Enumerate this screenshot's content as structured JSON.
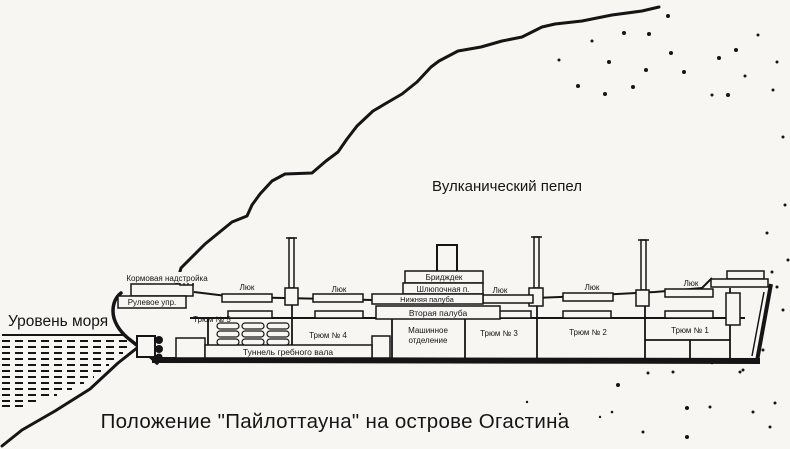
{
  "figure": {
    "caption": "Положение \"Пайлоттауна\" на острове Огастина",
    "environment": {
      "sea_level": "Уровень моря",
      "volcanic_ash": "Вулканический пепел"
    },
    "ship": {
      "stern_superstructure": "Кормовая надстройка",
      "steering_gear": "Рулевое упр.",
      "hatch": "Люк",
      "holds": {
        "h5": "Трюм № 5",
        "h4": "Трюм № 4",
        "h3": "Трюм № 3",
        "h2": "Трюм № 2",
        "h1": "Трюм № 1"
      },
      "shaft_tunnel": "Туннель гребного вала",
      "engine_room_line1": "Машинное",
      "engine_room_line2": "отделение",
      "decks": {
        "bridge": "Бридждек",
        "boat": "Шлюпочная п.",
        "lower": "Нижняя палуба",
        "second": "Вторая палуба"
      }
    },
    "colors": {
      "ink": "#151515",
      "paper": "#f7f6f2"
    }
  }
}
